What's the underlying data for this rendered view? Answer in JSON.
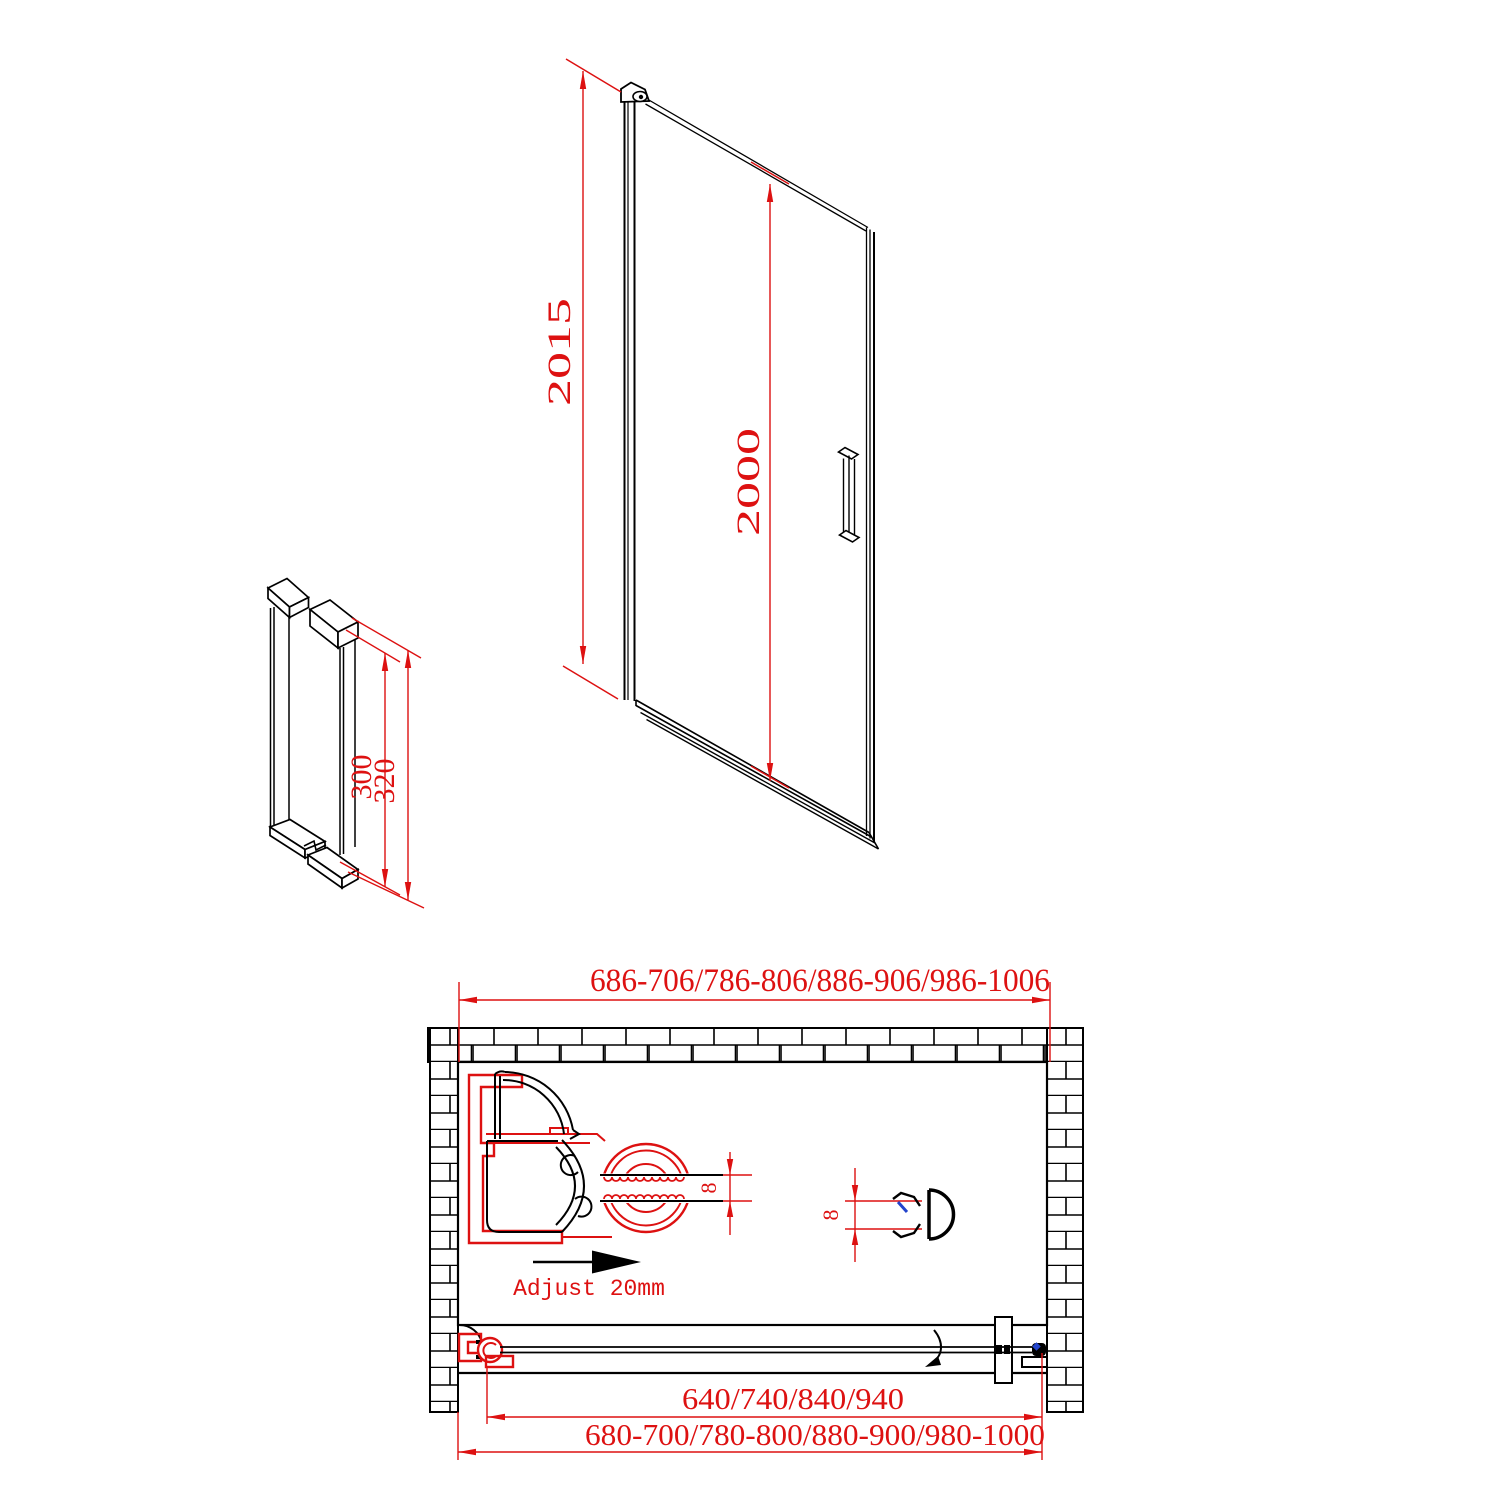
{
  "colors": {
    "line": "#000000",
    "dimension_red": "#dd1111",
    "accent_blue": "#2244cc",
    "background": "#ffffff"
  },
  "elevation": {
    "total_height": "2015",
    "glass_height": "2000"
  },
  "handle_detail": {
    "inner_length": "300",
    "outer_length": "320"
  },
  "plan": {
    "overall_width_range": "686-706/786-806/886-906/986-1006",
    "glass_width_options": "640/740/840/940",
    "install_width_range": "680-700/780-800/880-900/980-1000",
    "adjustment_note": "Adjust 20mm",
    "glass_thickness_hinge": "8",
    "glass_thickness_seal": "8"
  }
}
